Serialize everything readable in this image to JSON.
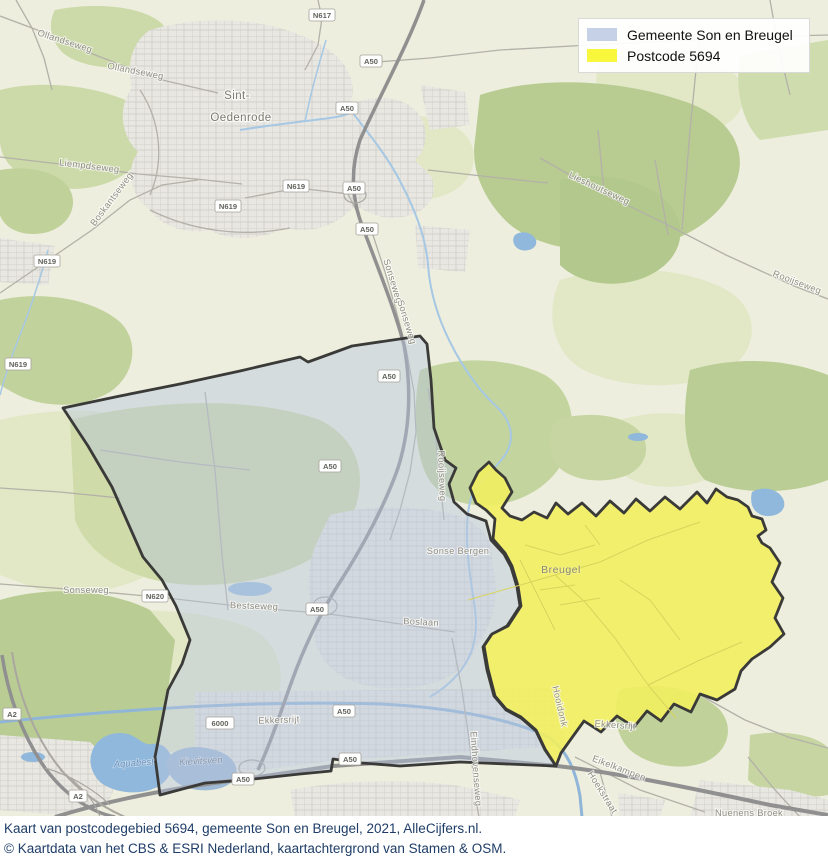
{
  "legend": {
    "items": [
      {
        "label": "Gemeente Son en Breugel",
        "color": "#c6d0e6"
      },
      {
        "label": "Postcode 5694",
        "color": "#f9f73c"
      }
    ]
  },
  "caption": {
    "line1": "Kaart van postcodegebied 5694, gemeente Son en Breugel, 2021, AlleCijfers.nl.",
    "line2": "© Kaartdata van het CBS & ESRI Nederland, kaartachtergrond van Stamen & OSM."
  },
  "map": {
    "regions": {
      "gemeente": {
        "name": "Gemeente Son en Breugel",
        "fill": "#b9c6dd",
        "border": "#3a3a38"
      },
      "postcode": {
        "name": "Postcode 5694",
        "fill": "#f2ee5f",
        "border": "#3a3a38"
      }
    },
    "labels": [
      {
        "text": "Sint-"
      },
      {
        "text": "Oedenrode"
      },
      {
        "text": "Ollandseweg"
      },
      {
        "text": "Ollandseweg"
      },
      {
        "text": "Liempdseweg"
      },
      {
        "text": "Boskantseweg"
      },
      {
        "text": "Sonseweg"
      },
      {
        "text": "Sonseweg"
      },
      {
        "text": "Rooijseweg"
      },
      {
        "text": "Rooijseweg"
      },
      {
        "text": "Lieshoutseweg"
      },
      {
        "text": "Sonseweg"
      },
      {
        "text": "Bestseweg"
      },
      {
        "text": "Breugel"
      },
      {
        "text": "Sonse Bergen"
      },
      {
        "text": "Boslaan"
      },
      {
        "text": "Ekkersrijt"
      },
      {
        "text": "Ekkersrijt"
      },
      {
        "text": "Aquabest"
      },
      {
        "text": "Kievitsven"
      },
      {
        "text": "Eindhovenseweg"
      },
      {
        "text": "Hooidonk"
      },
      {
        "text": "Eikelkampen"
      },
      {
        "text": "Hoekstraat"
      },
      {
        "text": "Nuenens Broek"
      }
    ],
    "shields": [
      {
        "text": "N617"
      },
      {
        "text": "A50"
      },
      {
        "text": "A50"
      },
      {
        "text": "N619"
      },
      {
        "text": "N619"
      },
      {
        "text": "N619"
      },
      {
        "text": "N619"
      },
      {
        "text": "A50"
      },
      {
        "text": "A50"
      },
      {
        "text": "A50"
      },
      {
        "text": "A50"
      },
      {
        "text": "N620"
      },
      {
        "text": "A50"
      },
      {
        "text": "6000"
      },
      {
        "text": "A50"
      },
      {
        "text": "A50"
      },
      {
        "text": "A50"
      },
      {
        "text": "A2"
      },
      {
        "text": "A2"
      }
    ]
  }
}
